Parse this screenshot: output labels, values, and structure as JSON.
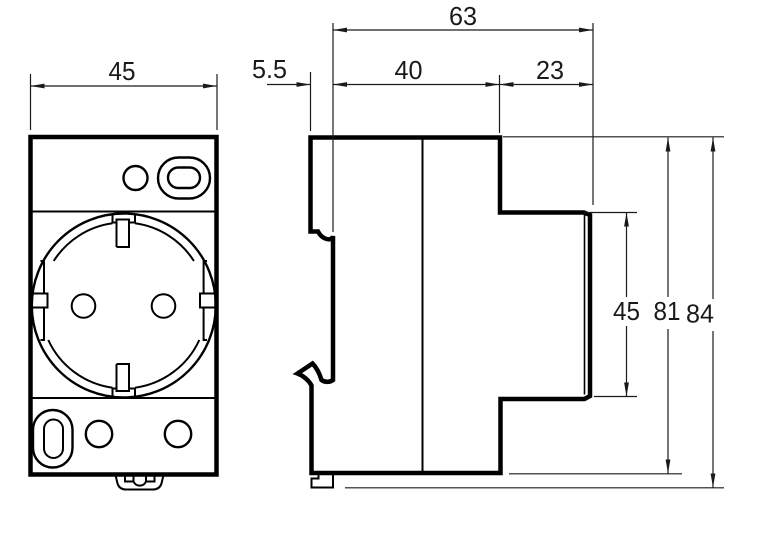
{
  "colors": {
    "ink": "#000000",
    "dimension_ink": "#1a1a1a",
    "background": "#ffffff"
  },
  "front_view": {
    "dim_width": "45"
  },
  "side_view": {
    "dim_rail_offset": "5.5",
    "dim_rail_to_front": "40",
    "dim_front_depth": "23",
    "dim_total_depth": "63",
    "dim_front_height": "45",
    "dim_body_height": "81",
    "dim_total_height": "84"
  }
}
